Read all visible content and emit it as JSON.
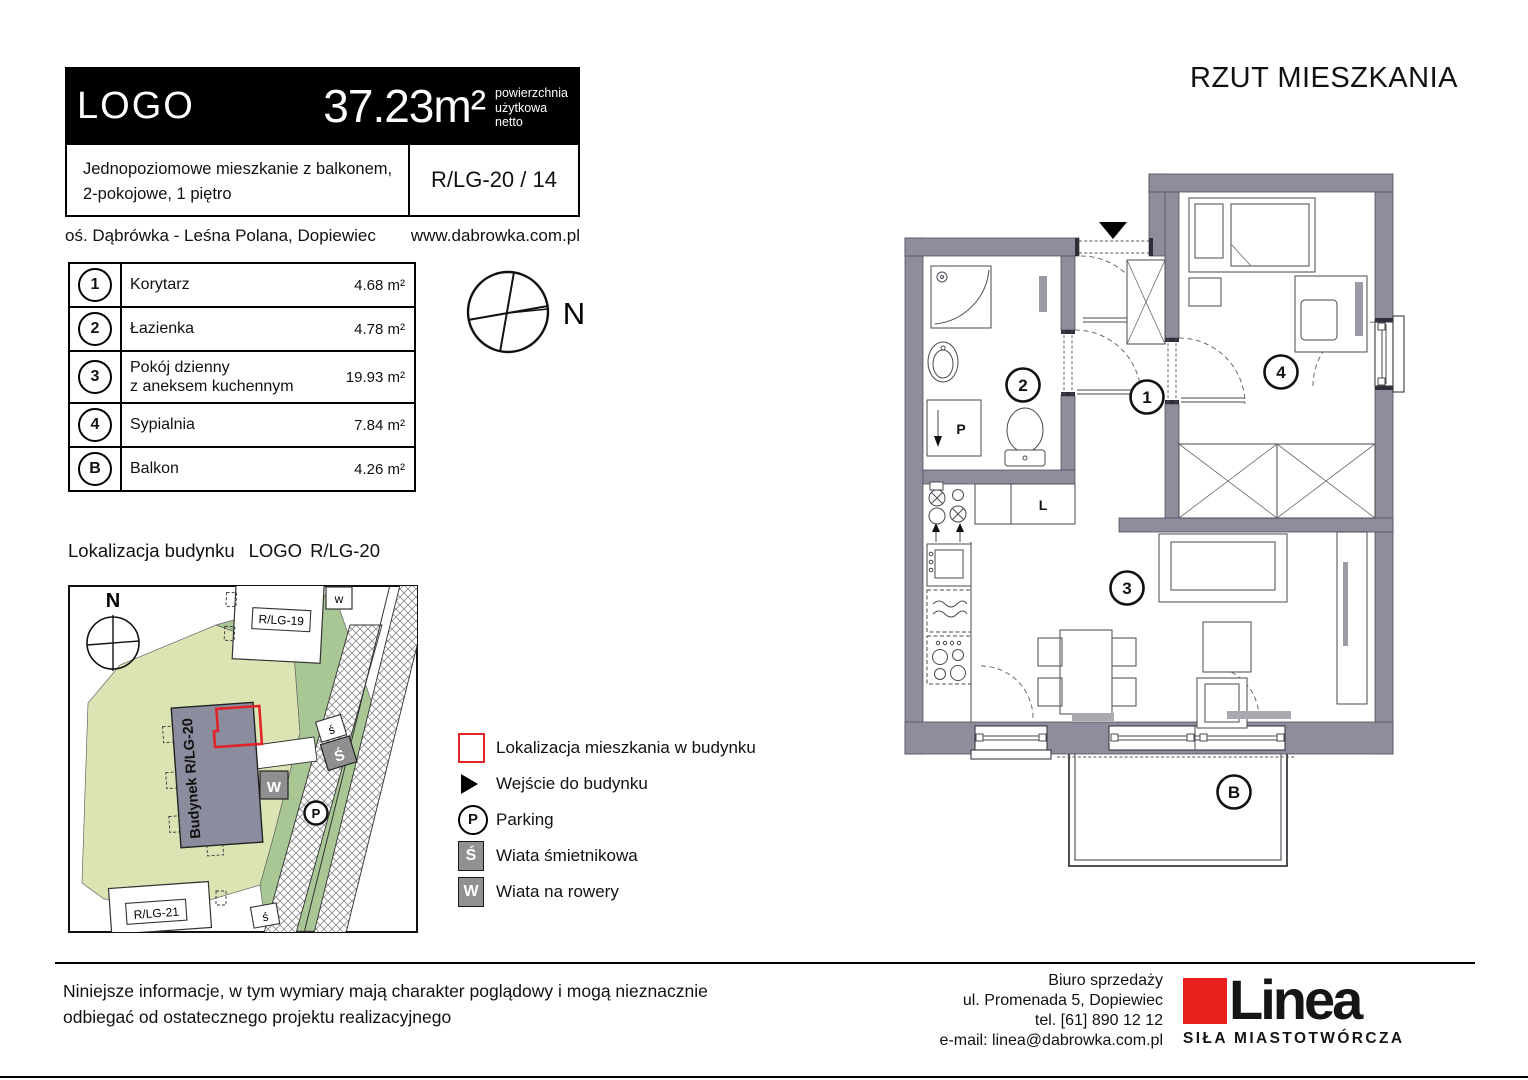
{
  "header": {
    "logo": "LOGO",
    "area_value": "37.23m²",
    "area_note1": "powierzchnia",
    "area_note2": "użytkowa",
    "area_note3": "netto",
    "desc1": "Jednopoziomowe mieszkanie z balkonem,",
    "desc2": "2-pokojowe, 1 piętro",
    "unit": "R/LG-20 / 14",
    "location": "oś. Dąbrówka - Leśna Polana, Dopiewiec",
    "website": "www.dabrowka.com.pl"
  },
  "plan": {
    "title": "RZUT MIESZKANIA",
    "fridge_label": "L",
    "washer_label": "P"
  },
  "rooms": [
    {
      "id": "1",
      "name": "Korytarz",
      "name2": "",
      "area": "4.68 m²"
    },
    {
      "id": "2",
      "name": "Łazienka",
      "name2": "",
      "area": "4.78 m²"
    },
    {
      "id": "3",
      "name": "Pokój dzienny",
      "name2": "z aneksem kuchennym",
      "area": "19.93 m²"
    },
    {
      "id": "4",
      "name": "Sypialnia",
      "name2": "",
      "area": "7.84 m²"
    },
    {
      "id": "B",
      "name": "Balkon",
      "name2": "",
      "area": "4.26 m²"
    }
  ],
  "site": {
    "heading_prefix": "Lokalizacja budynku",
    "heading_name": "LOGO",
    "heading_code": "R/LG-20",
    "building_label": "Budynek R/LG-20",
    "neighbor_top": "R/LG-19",
    "neighbor_bottom": "R/LG-21",
    "north": "N",
    "marker_parking": "P",
    "marker_trash": "Ś",
    "marker_trash_small": "ś",
    "marker_bike": "W",
    "marker_bike_small": "w"
  },
  "compass": {
    "north": "N"
  },
  "legend": [
    {
      "label": "Lokalizacja mieszkania w budynku"
    },
    {
      "label": "Wejście do budynku"
    },
    {
      "label": "Parking"
    },
    {
      "label": "Wiata śmietnikowa"
    },
    {
      "label": "Wiata na rowery"
    }
  ],
  "footer": {
    "disclaimer1": "Niniejsze informacje, w tym wymiary mają charakter poglądowy i mogą nieznacznie",
    "disclaimer2": "odbiegać od ostatecznego projektu realizacyjnego",
    "office": [
      "Biuro sprzedaży",
      "ul. Promenada 5, Dopiewiec",
      "tel. [61] 890 12 12",
      "e-mail: linea@dabrowka.com.pl"
    ],
    "brand_name": "Linea",
    "brand_tagline": "SIŁA MIASTOTWÓRCZA"
  },
  "colors": {
    "wall": "#8d8d9c",
    "accent_red": "#e02428",
    "plot_light_green": "#dbe5b4",
    "plot_dark_green": "#a9c795",
    "shed_gray": "#919191"
  }
}
